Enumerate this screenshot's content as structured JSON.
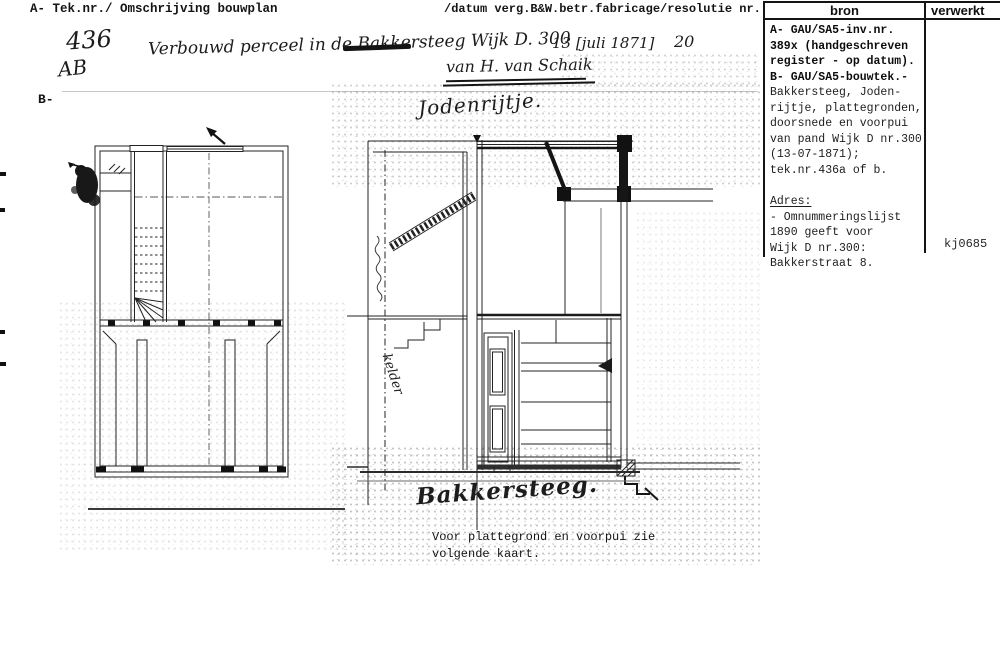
{
  "header": {
    "left": "A- Tek.nr./ Omschrijving bouwplan",
    "right": "/datum verg.B&W.betr.fabricage/resolutie nr.",
    "section_b_label": "B-"
  },
  "handwritten": {
    "tek_nr": "436",
    "tek_suffix": "AB",
    "description": "Verbouwd perceel in de Bakkersteeg Wijk D. 300",
    "date": "13 [juli 1871]",
    "resolutie_nr": "20",
    "applicant": "van H. van Schaik"
  },
  "drawing": {
    "street_top_label": "Jodenrijtje.",
    "street_bottom_label": "Bakkersteeg.",
    "kelder_label": "kelder",
    "caption_line1": "Voor plattegrond en voorpui zie",
    "caption_line2": "volgende kaart."
  },
  "source_panel": {
    "col_bron": "bron",
    "col_verwerkt": "verwerkt",
    "bron_lines": [
      {
        "text": "A- GAU/SA5-inv.nr.",
        "bold": true
      },
      {
        "text": "389x (handgeschreven",
        "bold": true
      },
      {
        "text": "register - op datum).",
        "bold": true
      },
      {
        "text": "B- GAU/SA5-bouwtek.-",
        "bold": true
      },
      {
        "text": "Bakkersteeg, Joden-"
      },
      {
        "text": "rijtje, plattegronden,"
      },
      {
        "text": "doorsnede en voorpui"
      },
      {
        "text": "van pand Wijk D nr.300;"
      },
      {
        "text": "(13-07-1871);"
      },
      {
        "text": "tek.nr.436a of b."
      },
      {
        "text": ""
      },
      {
        "text": "Adres:",
        "underline": true
      },
      {
        "text": "- Omnummeringslijst"
      },
      {
        "text": "1890 geeft voor"
      },
      {
        "text": "Wijk D nr.300:"
      },
      {
        "text": "Bakkerstraat 8."
      }
    ],
    "verwerkt_code": "kj0685"
  },
  "colors": {
    "ink": "#1a1a1a",
    "paper": "#ffffff"
  }
}
